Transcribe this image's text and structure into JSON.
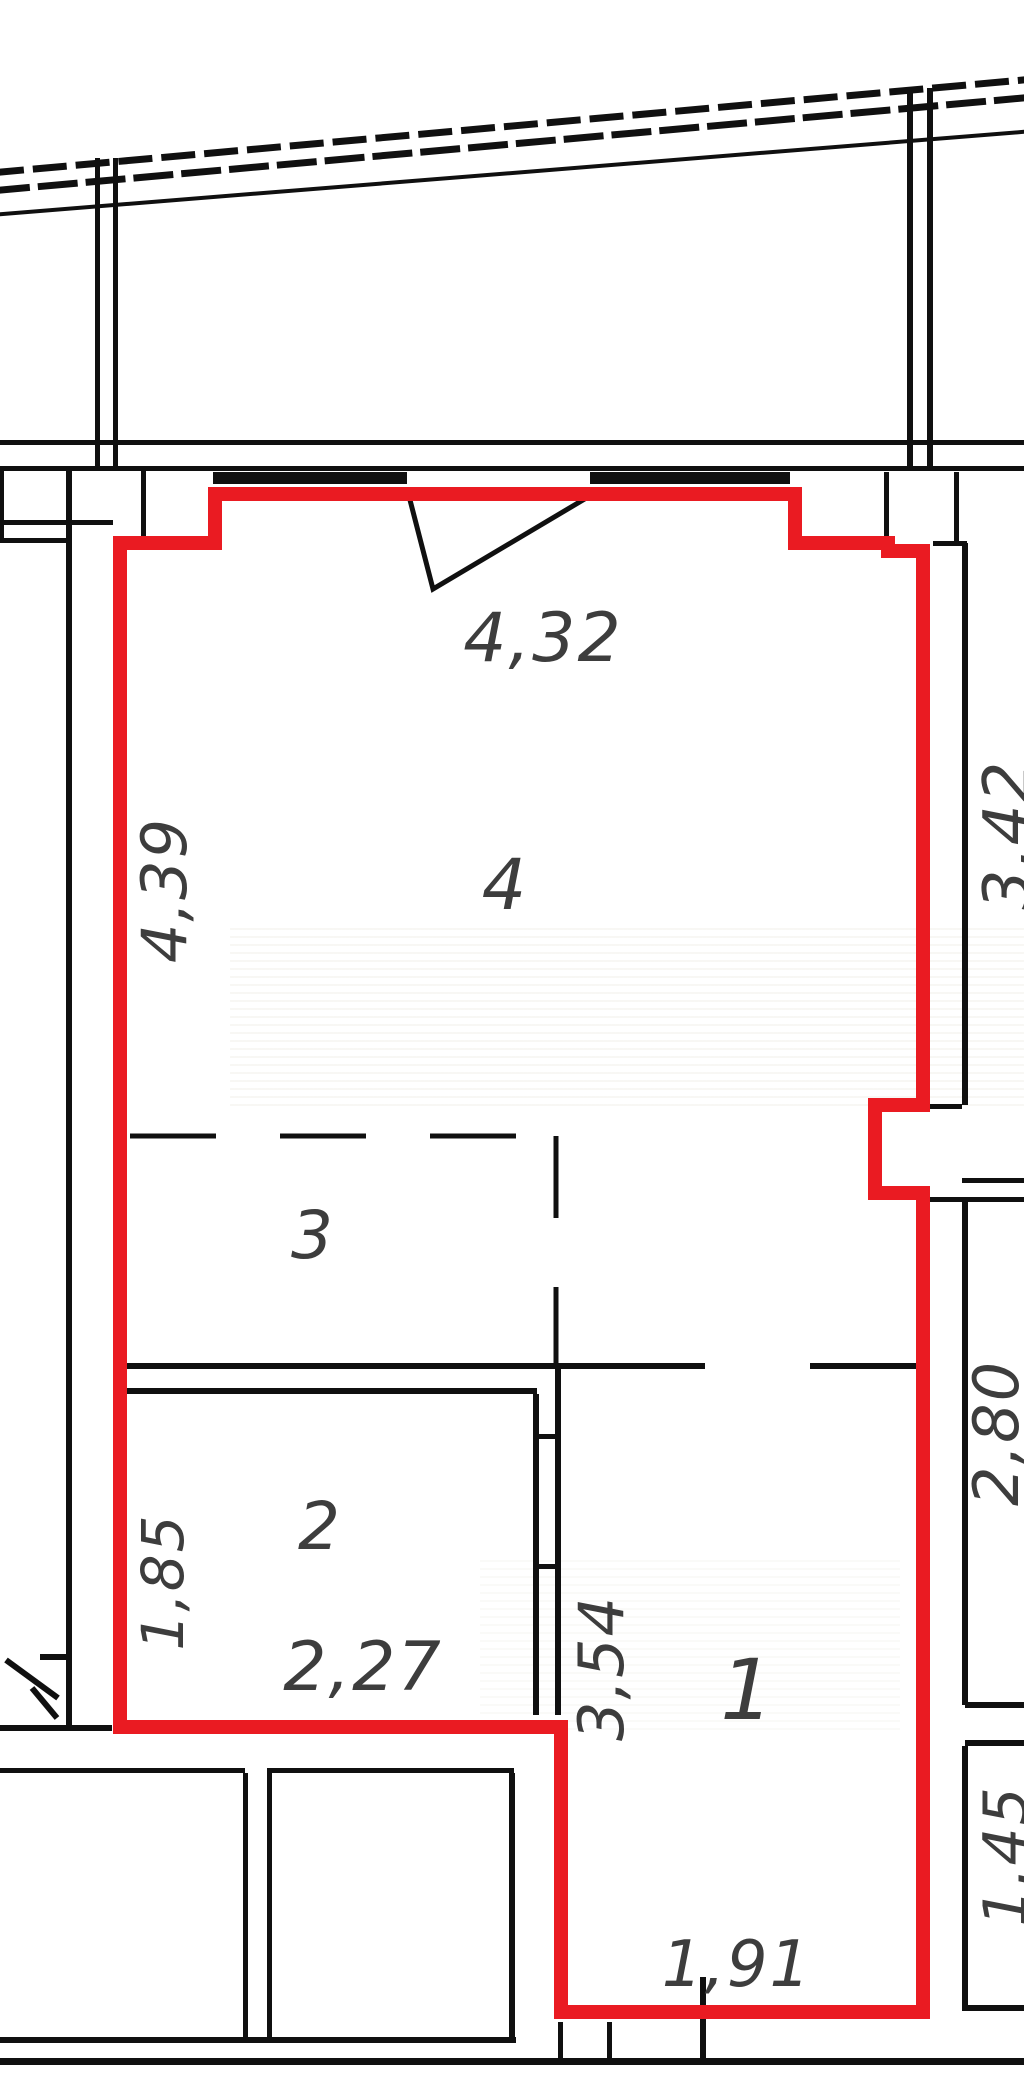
{
  "drawing": {
    "kind": "apartment floor plan fragment",
    "unit_outline_color": "#ea1b22",
    "wall_color": "#101010",
    "dimension_text_color": "#3d3d3d"
  },
  "rooms": [
    {
      "number": "4",
      "position": "upper large room"
    },
    {
      "number": "3",
      "position": "middle area, dashed boundary"
    },
    {
      "number": "2",
      "position": "lower-left room"
    },
    {
      "number": "1",
      "position": "lower-right room"
    }
  ],
  "dimensions": [
    {
      "value": "4,32",
      "location": "top wall width"
    },
    {
      "value": "3,42",
      "location": "right side upper"
    },
    {
      "value": "2,80",
      "location": "right side middle"
    },
    {
      "value": "1,45",
      "location": "right side lower"
    },
    {
      "value": "1,91",
      "location": "bottom edge"
    },
    {
      "value": "3,54",
      "location": "middle vertical wall"
    },
    {
      "value": "2,27",
      "location": "room 2 width"
    },
    {
      "value": "1,85",
      "location": "room 2 left height"
    },
    {
      "value": "4,39",
      "location": "left wall height"
    }
  ]
}
